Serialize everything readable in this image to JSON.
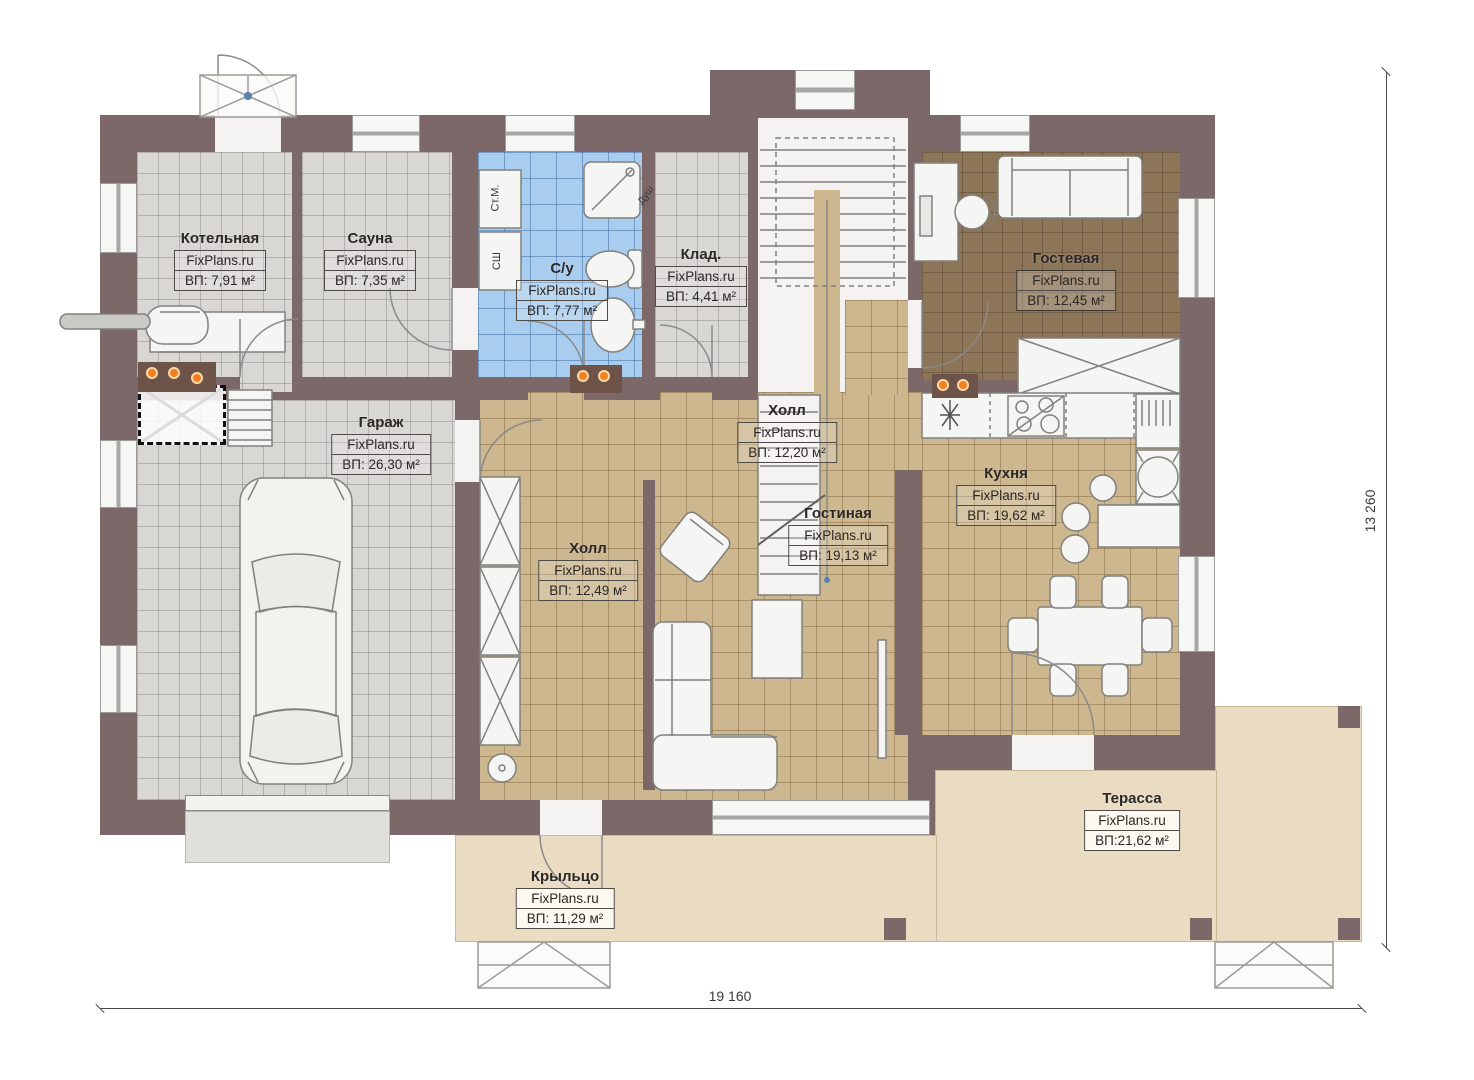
{
  "plan": {
    "brand": "FixPlans.ru",
    "dimensions": {
      "width_label": "19 160",
      "height_label": "13 260"
    },
    "rooms": [
      {
        "name": "Котельная",
        "brand": "FixPlans.ru",
        "area": "ВП: 7,91 м²"
      },
      {
        "name": "Сауна",
        "brand": "FixPlans.ru",
        "area": "ВП: 7,35 м²"
      },
      {
        "name": "С/у",
        "brand": "FixPlans.ru",
        "area": "ВП: 7,77 м²"
      },
      {
        "name": "Клад.",
        "brand": "FixPlans.ru",
        "area": "ВП: 4,41 м²"
      },
      {
        "name": "Гостевая",
        "brand": "FixPlans.ru",
        "area": "ВП: 12,45 м²"
      },
      {
        "name": "Гараж",
        "brand": "FixPlans.ru",
        "area": "ВП: 26,30 м²"
      },
      {
        "name": "Холл",
        "brand": "FixPlans.ru",
        "area": "ВП: 12,20 м²"
      },
      {
        "name": "Гостиная",
        "brand": "FixPlans.ru",
        "area": "ВП: 19,13 м²"
      },
      {
        "name": "Кухня",
        "brand": "FixPlans.ru",
        "area": "ВП: 19,62 м²"
      },
      {
        "name": "Холл",
        "brand": "FixPlans.ru",
        "area": "ВП: 12,49 м²"
      },
      {
        "name": "Терасса",
        "brand": "FixPlans.ru",
        "area": "ВП:21,62 м²"
      },
      {
        "name": "Крыльцо",
        "brand": "FixPlans.ru",
        "area": "ВП: 11,29 м²"
      }
    ],
    "annotations": {
      "washer": "Ст.М.",
      "dryer": "СШ",
      "shower": "Душ"
    },
    "colors": {
      "wall": "#7c6769",
      "floor_grey": "#d8d7d4",
      "floor_blue": "#a9cdee",
      "floor_beige": "#ccb78e",
      "floor_guest": "#8d7557",
      "terrace": "#e9dcc3",
      "heat_marker_orange": "#f28022"
    }
  }
}
